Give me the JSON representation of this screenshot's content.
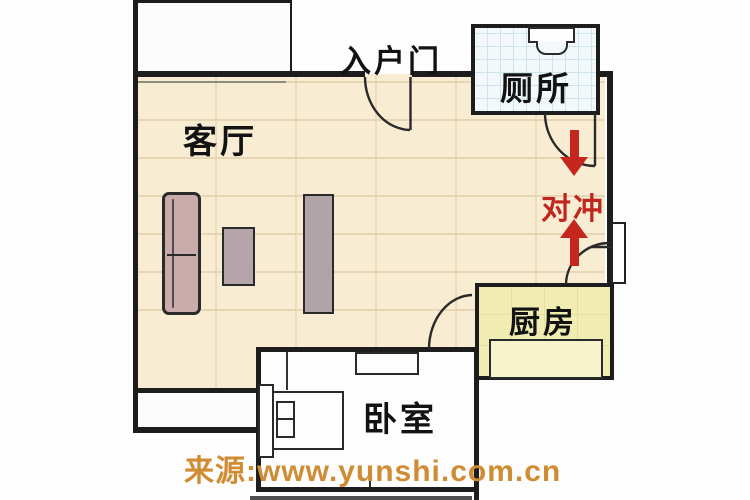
{
  "rooms": {
    "living_room": {
      "label": "客厅"
    },
    "toilet": {
      "label": "厕所"
    },
    "kitchen": {
      "label": "厨房"
    },
    "bedroom": {
      "label": "卧室"
    },
    "entrance": {
      "label": "入户门"
    }
  },
  "annotation": {
    "clash_label": "对冲",
    "arrows": [
      "down",
      "up"
    ]
  },
  "watermark": {
    "text": "来源:www.yunshi.com.cn"
  },
  "colors": {
    "floor_beige": "#f8ecd2",
    "tile_line": "#e8d5b3",
    "kitchen_yellow": "#f1edb2",
    "counter_yellow": "#f7f3cd",
    "toilet_tile_bg": "#f3f9fa",
    "toilet_grid": "#cfe4ea",
    "wall_black": "#1d1d1d",
    "arrow_red": "#c5261d",
    "clash_text_red": "#c0261e",
    "watermark_orange": "#cf8c33",
    "furniture_mauve": "#c9abab"
  }
}
